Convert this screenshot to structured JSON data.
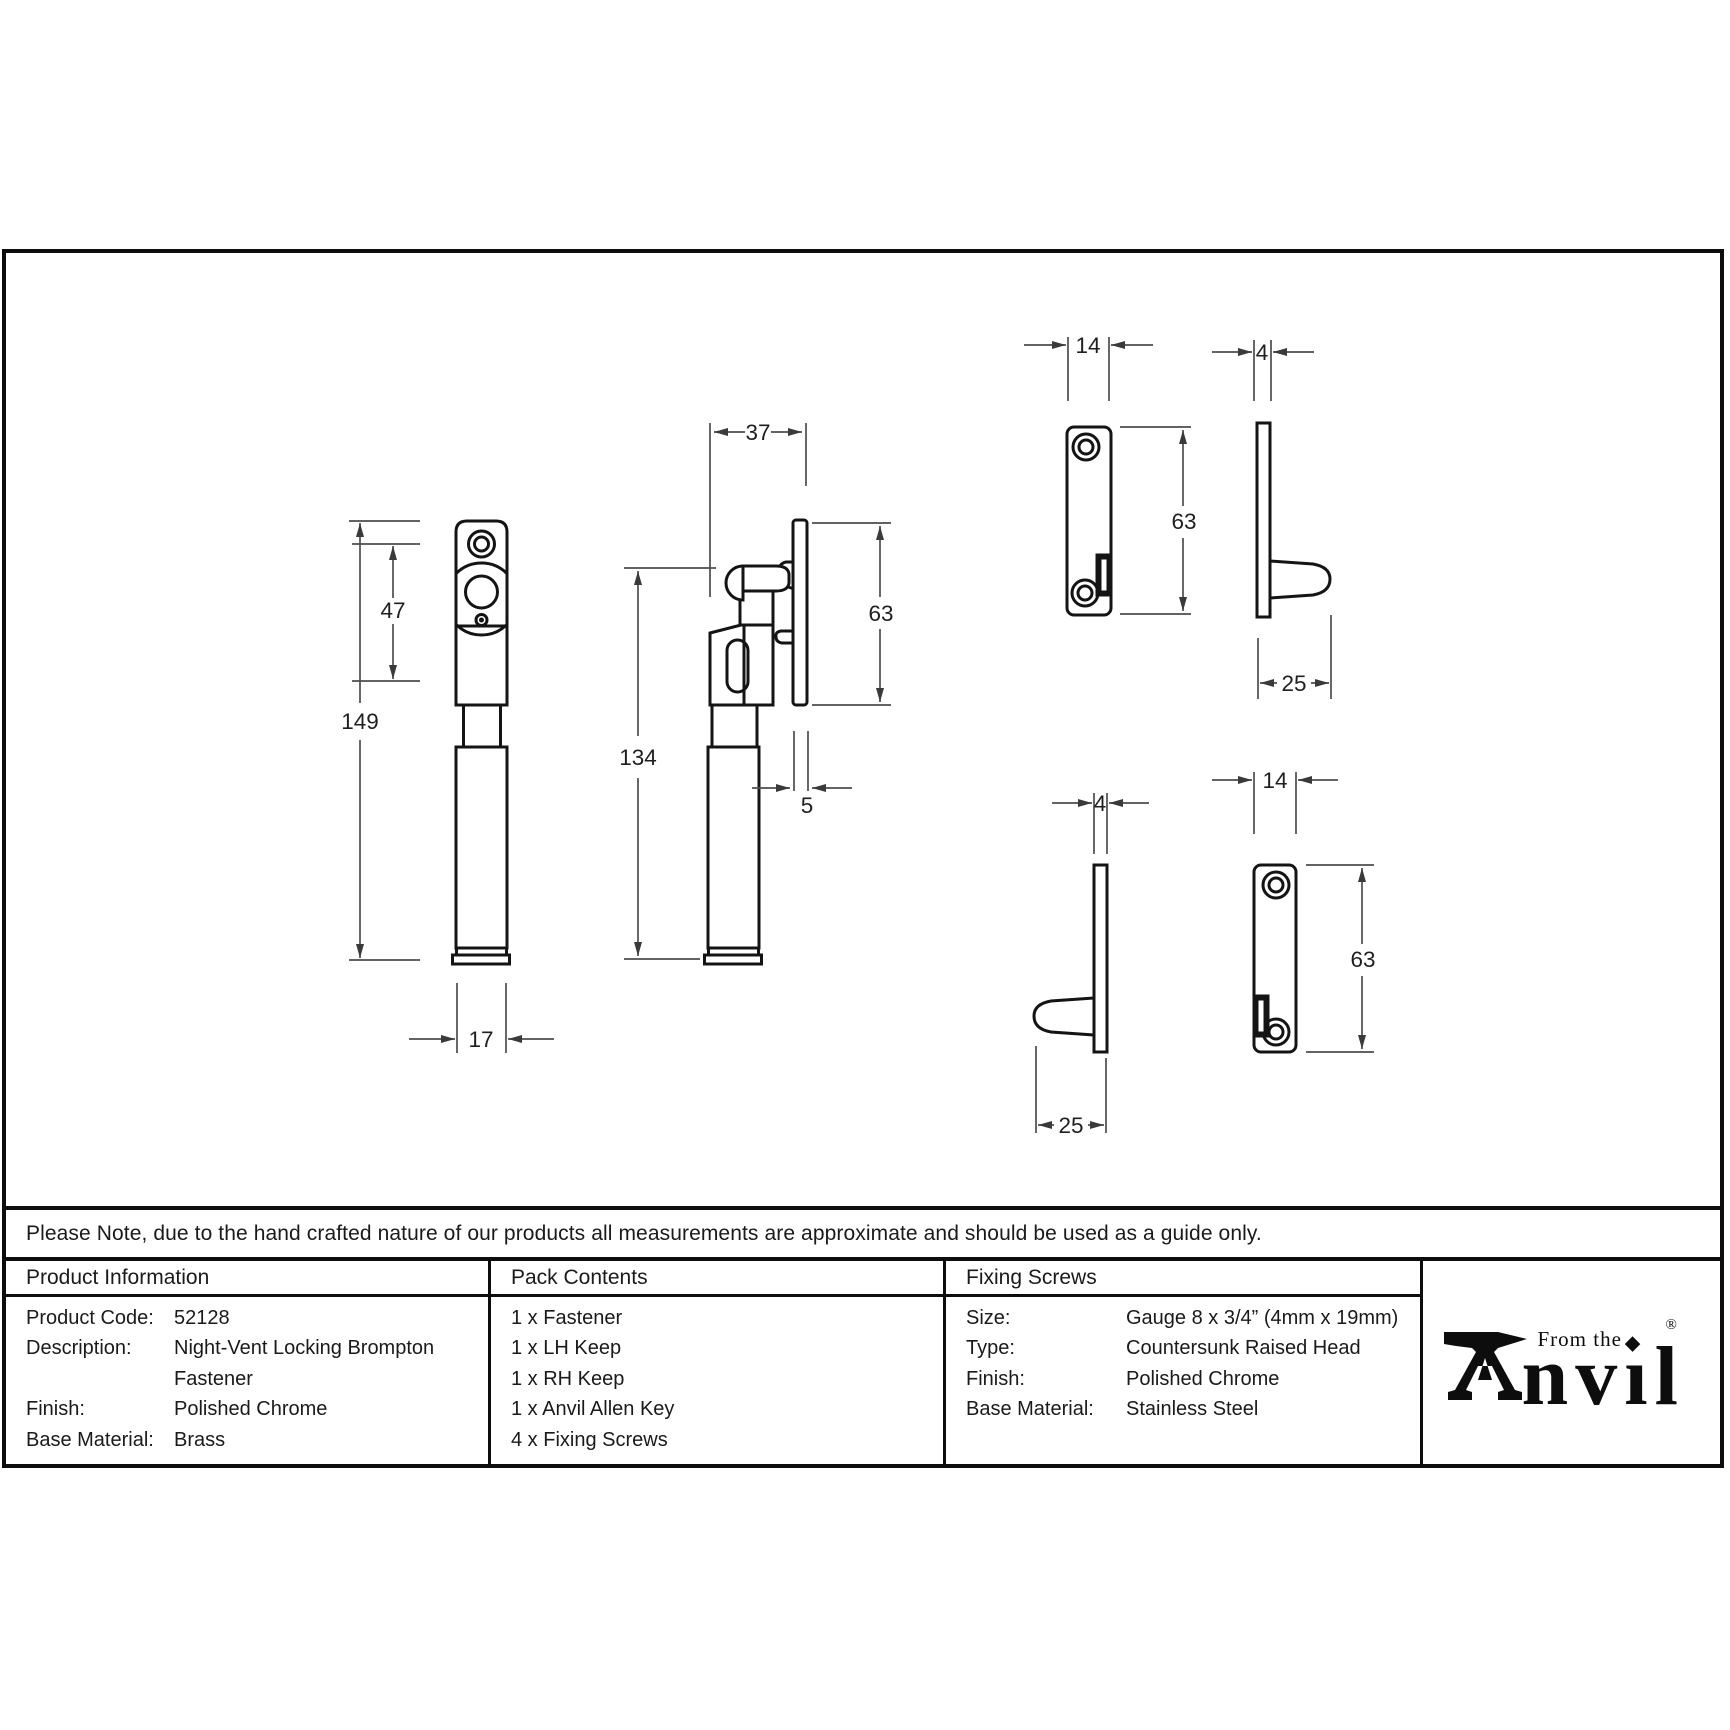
{
  "drawing": {
    "dims": {
      "front_overall_height": "149",
      "front_backplate_height": "47",
      "front_width": "17",
      "side_depth": "37",
      "side_height": "134",
      "side_keep_height": "63",
      "side_keep_plate_thickness": "5",
      "keep_top_front_width": "14",
      "keep_top_front_height": "63",
      "keep_top_side_thickness": "4",
      "keep_top_side_depth": "25",
      "keep_bottom_side_thickness": "4",
      "keep_bottom_side_depth": "25",
      "keep_bottom_front_width": "14",
      "keep_bottom_front_height": "63"
    }
  },
  "note": "Please Note, due to the hand crafted nature of our products all measurements are approximate and should be used as a guide only.",
  "table": {
    "product_information": {
      "header": "Product Information",
      "rows": [
        {
          "label": "Product Code:",
          "value": "52128"
        },
        {
          "label": "Description:",
          "value": "Night-Vent Locking Brompton"
        },
        {
          "label": "",
          "value": "Fastener"
        },
        {
          "label": "Finish:",
          "value": "Polished Chrome"
        },
        {
          "label": "Base Material:",
          "value": "Brass"
        }
      ]
    },
    "pack_contents": {
      "header": "Pack Contents",
      "items": [
        "1 x Fastener",
        "1 x LH Keep",
        "1 x RH Keep",
        "1 x Anvil Allen Key",
        "4 x Fixing Screws"
      ]
    },
    "fixing_screws": {
      "header": "Fixing Screws",
      "rows": [
        {
          "label": "Size:",
          "value": "Gauge 8 x 3/4” (4mm x 19mm)"
        },
        {
          "label": "Type:",
          "value": "Countersunk Raised Head"
        },
        {
          "label": "Finish:",
          "value": "Polished Chrome"
        },
        {
          "label": "Base Material:",
          "value": "Stainless Steel"
        }
      ]
    }
  },
  "logo": {
    "brand": "From the Anvil",
    "tagline": "From the",
    "word_nv": "nv",
    "word_dotless_i": "ı",
    "word_l": "l",
    "diamond": "◆",
    "registered": "®"
  },
  "colors": {
    "ink": "#0d0d0d",
    "dim_line": "#4d4d4d"
  }
}
